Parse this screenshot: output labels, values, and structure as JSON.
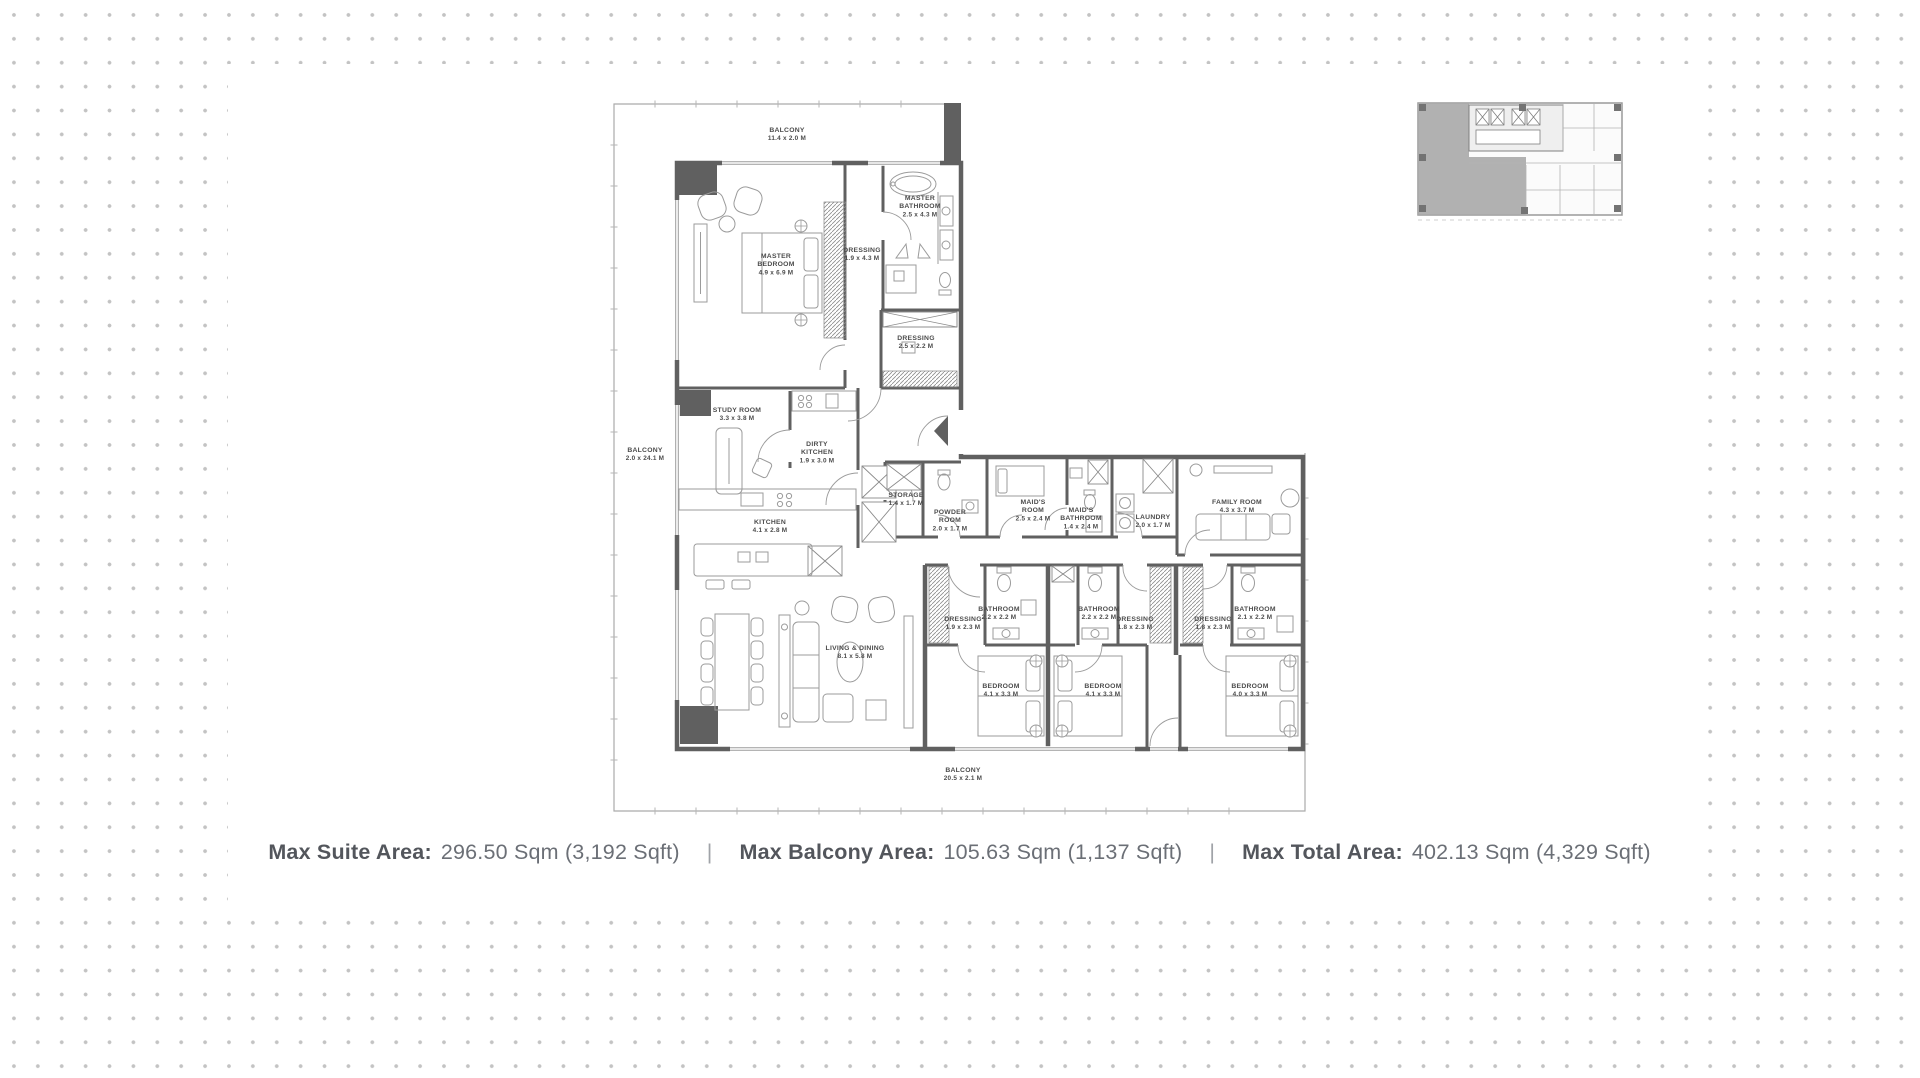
{
  "colors": {
    "wall": "#606060",
    "furniture": "#9b9b9b",
    "label": "#4c4c4c",
    "outer_line": "#ababab",
    "dot": "#c3c3c3",
    "key_plan_highlight": "#a8a8a8"
  },
  "stats": {
    "separator": "|",
    "items": [
      {
        "label": "Max Suite Area:",
        "value": "296.50 Sqm (3,192 Sqft)"
      },
      {
        "label": "Max Balcony Area:",
        "value": "105.63 Sqm (1,137 Sqft)"
      },
      {
        "label": "Max Total Area:",
        "value": "402.13 Sqm (4,329 Sqft)"
      }
    ]
  },
  "floor_plan": {
    "rooms": [
      {
        "id": "balcony-top",
        "name_lines": [
          "BALCONY"
        ],
        "dims": "11.4 x 2.0 M"
      },
      {
        "id": "master-bedroom",
        "name_lines": [
          "MASTER",
          "BEDROOM"
        ],
        "dims": "4.9 x 6.9 M"
      },
      {
        "id": "dressing-master",
        "name_lines": [
          "DRESSING"
        ],
        "dims": "1.9 x 4.3 M"
      },
      {
        "id": "master-bathroom",
        "name_lines": [
          "MASTER",
          "BATHROOM"
        ],
        "dims": "2.5 x 4.3 M"
      },
      {
        "id": "dressing-2",
        "name_lines": [
          "DRESSING"
        ],
        "dims": "2.5 x 2.2 M"
      },
      {
        "id": "balcony-left",
        "name_lines": [
          "BALCONY"
        ],
        "dims": "2.0 x 24.1 M"
      },
      {
        "id": "study-room",
        "name_lines": [
          "STUDY ROOM"
        ],
        "dims": "3.3 x 3.8 M"
      },
      {
        "id": "dirty-kitchen",
        "name_lines": [
          "DIRTY",
          "KITCHEN"
        ],
        "dims": "1.9 x 3.0 M"
      },
      {
        "id": "kitchen",
        "name_lines": [
          "KITCHEN"
        ],
        "dims": "4.1 x 2.8 M"
      },
      {
        "id": "storage",
        "name_lines": [
          "STORAGE"
        ],
        "dims": "1.4 x 1.7 M"
      },
      {
        "id": "powder-room",
        "name_lines": [
          "POWDER",
          "ROOM"
        ],
        "dims": "2.0 x 1.7 M"
      },
      {
        "id": "maids-room",
        "name_lines": [
          "MAID'S",
          "ROOM"
        ],
        "dims": "2.5 x 2.4 M"
      },
      {
        "id": "maids-bathroom",
        "name_lines": [
          "MAID'S",
          "BATHROOM"
        ],
        "dims": "1.4 x 2.4 M"
      },
      {
        "id": "laundry",
        "name_lines": [
          "LAUNDRY"
        ],
        "dims": "2.0 x 1.7 M"
      },
      {
        "id": "family-room",
        "name_lines": [
          "FAMILY ROOM"
        ],
        "dims": "4.3 x 3.7 M"
      },
      {
        "id": "living-dining",
        "name_lines": [
          "LIVING & DINING"
        ],
        "dims": "8.1 x 5.8 M"
      },
      {
        "id": "dressing-s1",
        "name_lines": [
          "DRESSING"
        ],
        "dims": "1.9 x 2.3 M"
      },
      {
        "id": "bathroom-s1",
        "name_lines": [
          "BATHROOM"
        ],
        "dims": "2.2 x 2.2 M"
      },
      {
        "id": "bedroom-1",
        "name_lines": [
          "BEDROOM"
        ],
        "dims": "4.1 x 3.3 M"
      },
      {
        "id": "bathroom-s2",
        "name_lines": [
          "BATHROOM"
        ],
        "dims": "2.2 x 2.2 M"
      },
      {
        "id": "dressing-s2",
        "name_lines": [
          "DRESSING"
        ],
        "dims": "1.8 x 2.3 M"
      },
      {
        "id": "bedroom-2",
        "name_lines": [
          "BEDROOM"
        ],
        "dims": "4.1 x 3.3 M"
      },
      {
        "id": "dressing-s3",
        "name_lines": [
          "DRESSING"
        ],
        "dims": "1.8 x 2.3 M"
      },
      {
        "id": "bathroom-s3",
        "name_lines": [
          "BATHROOM"
        ],
        "dims": "2.1 x 2.2 M"
      },
      {
        "id": "bedroom-3",
        "name_lines": [
          "BEDROOM"
        ],
        "dims": "4.0 x 3.3 M"
      },
      {
        "id": "balcony-bottom",
        "name_lines": [
          "BALCONY"
        ],
        "dims": "20.5 x 2.1 M"
      }
    ]
  }
}
